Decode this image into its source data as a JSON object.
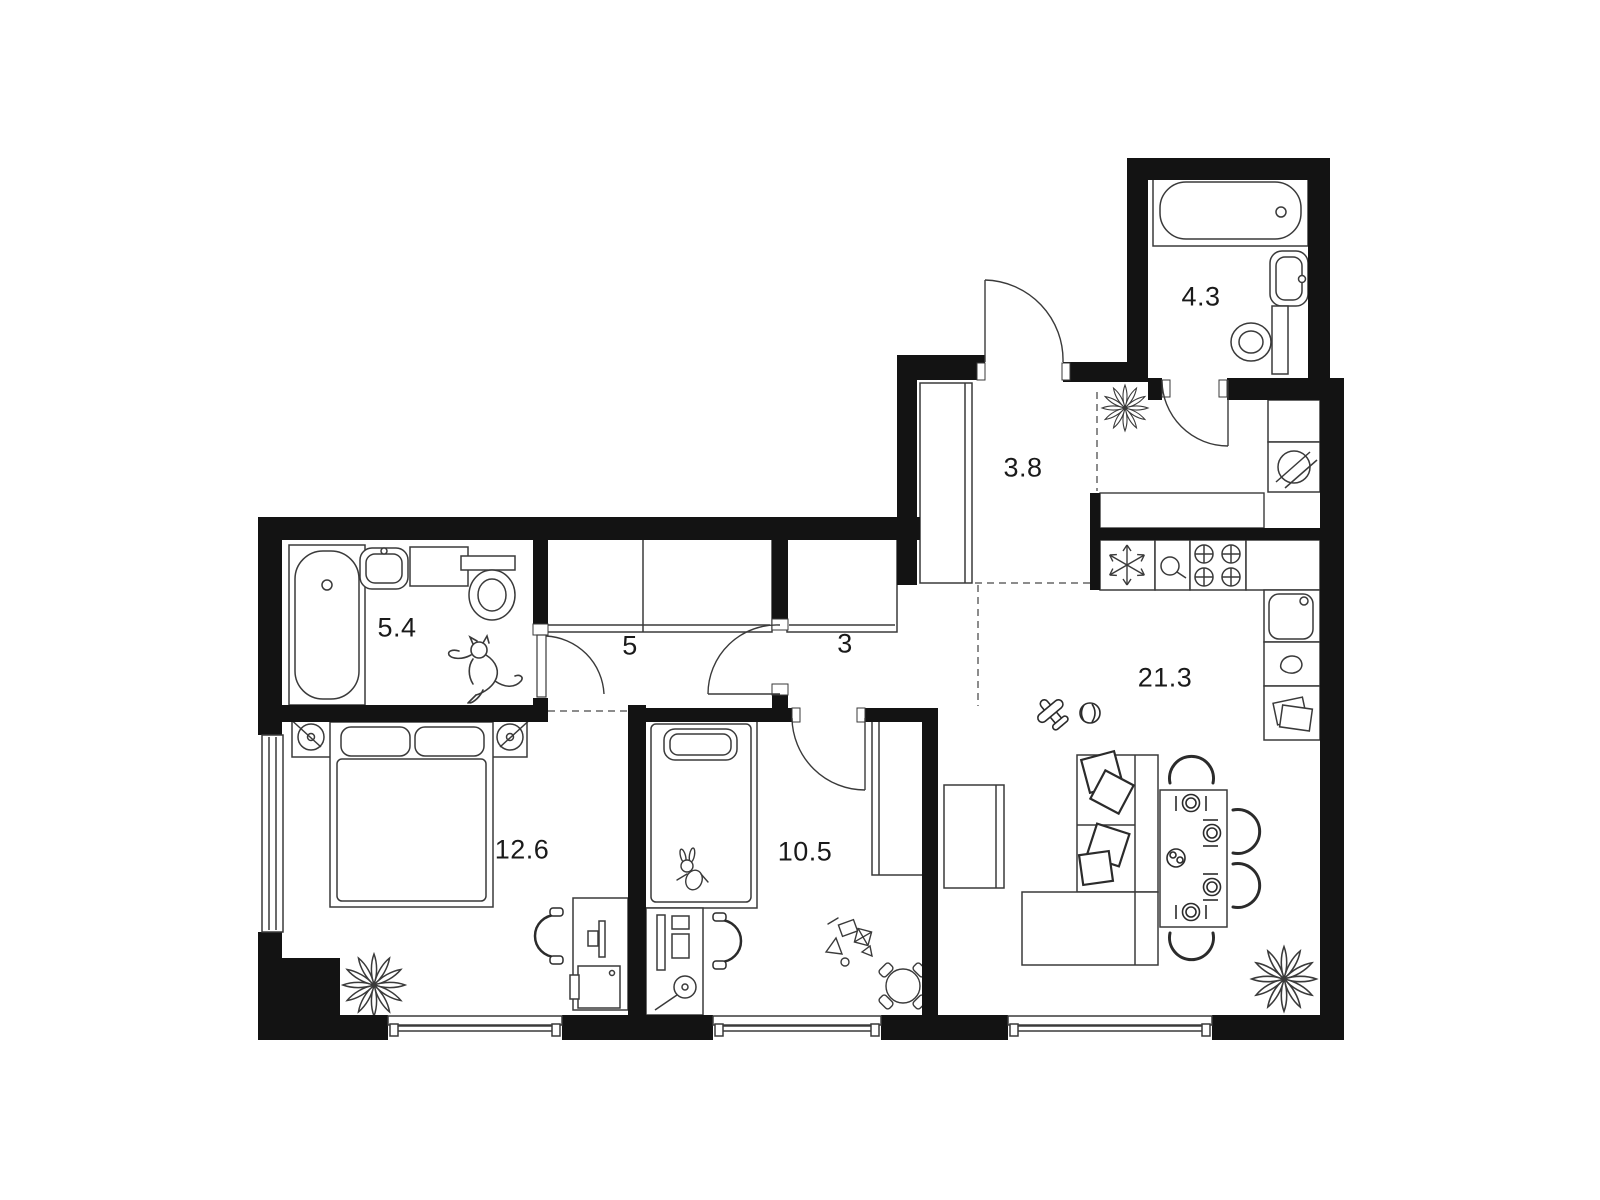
{
  "rooms": [
    {
      "key": "bathroom-1",
      "area": "5.4"
    },
    {
      "key": "corridor",
      "area": "5"
    },
    {
      "key": "hall",
      "area": "3"
    },
    {
      "key": "entrance-hall",
      "area": "3.8"
    },
    {
      "key": "bathroom-2",
      "area": "4.3"
    },
    {
      "key": "bedroom",
      "area": "12.6"
    },
    {
      "key": "kids-room",
      "area": "10.5"
    },
    {
      "key": "living-kitchen",
      "area": "21.3"
    }
  ],
  "colors": {
    "wall": "#131313",
    "furniture_line": "#3a3a3a",
    "bold_line": "#2b2b2b",
    "background": "#ffffff",
    "label_text": "#1a1a1a"
  },
  "icons": {
    "bathtub": "rounded-rect-outline-with-drain",
    "toilet": "oval-bowl-with-tank",
    "bath-sink": "rounded-basin",
    "washing-machine": "circle-with-diagonal-slashes",
    "fridge": "snowflake",
    "stove": "four-burner-crossed-circles",
    "kitchen-sink": "square-basin-with-tap-hole",
    "dishwasher": "water-drop",
    "shelf-unit": "stacked-papers",
    "plant": "petal-star",
    "cat": "leaping-cat-outline",
    "sofa": "l-shaped-sectional",
    "pillow": "rotated-square",
    "dining-table": "rect-with-place-settings",
    "chair": "horseshoe-arc",
    "desk-chair": "arc-with-pads",
    "bed": "rect-with-pillows",
    "wardrobe": "rect-with-slide-track",
    "desk": "rect-with-monitor",
    "toy-plane": "crossed-capsules",
    "ball": "circle-with-arcs",
    "bunny-toy": "small-animal-outline",
    "kids-table": "circle-with-seats",
    "window": "double-glazing-lines",
    "door": "quarter-circle-arc"
  }
}
